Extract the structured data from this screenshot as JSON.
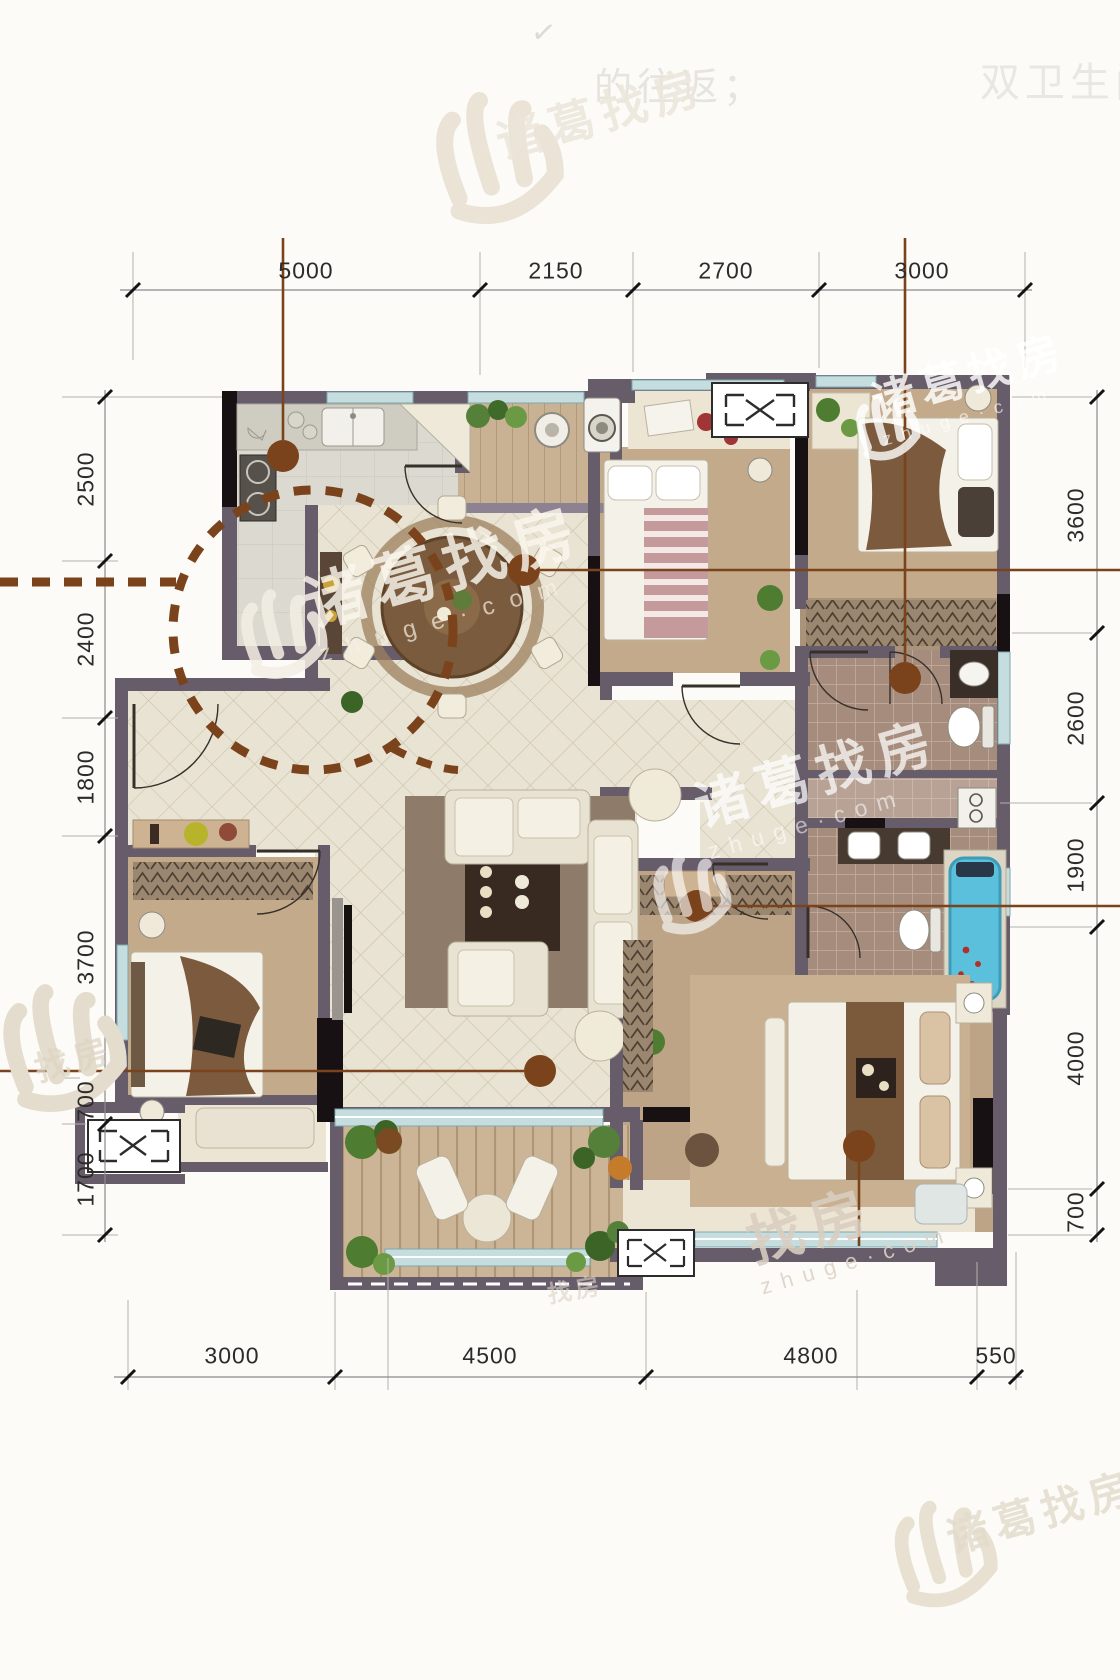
{
  "drawing": {
    "type": "apartment floor plan",
    "rooms_visible_unlabeled": true
  },
  "dims": {
    "top": [
      "5000",
      "2150",
      "2700",
      "3000"
    ],
    "bottom": [
      "3000",
      "4500",
      "4800",
      "550"
    ],
    "left": [
      "2500",
      "2400",
      "1800",
      "3700",
      "700",
      "1700"
    ],
    "right": [
      "3600",
      "2600",
      "1900",
      "4000",
      "700"
    ]
  },
  "watermark": {
    "name": "诸葛找房",
    "name_short": "找房",
    "domain": "zhuge·com"
  },
  "ghost_texts": {
    "mark": "✓",
    "line_left": "的往返；",
    "line_right": "双卫生间"
  },
  "colors": {
    "wall": "#675c6a",
    "wall_dark": "#161013",
    "tile_floor": "#e9e3d3",
    "carpet": "#c3aa8b",
    "wood": "#c9b294",
    "bath_tile": "#a68c7c",
    "window_glass": "#c6dde0",
    "annotation_brown": "#7b431b",
    "bathtub_blue": "#5bc0dc",
    "dimension_text": "#2d2b29"
  },
  "icons": [
    "ac-unit-icon",
    "door-arc-icon",
    "dining-table-icon",
    "sofa-icon",
    "bed-icon",
    "toilet-icon",
    "bathtub-icon",
    "sink-icon",
    "stove-icon",
    "washing-machine-icon",
    "wardrobe-hangers-icon",
    "plant-icon",
    "watermark-hand-logo-icon"
  ]
}
